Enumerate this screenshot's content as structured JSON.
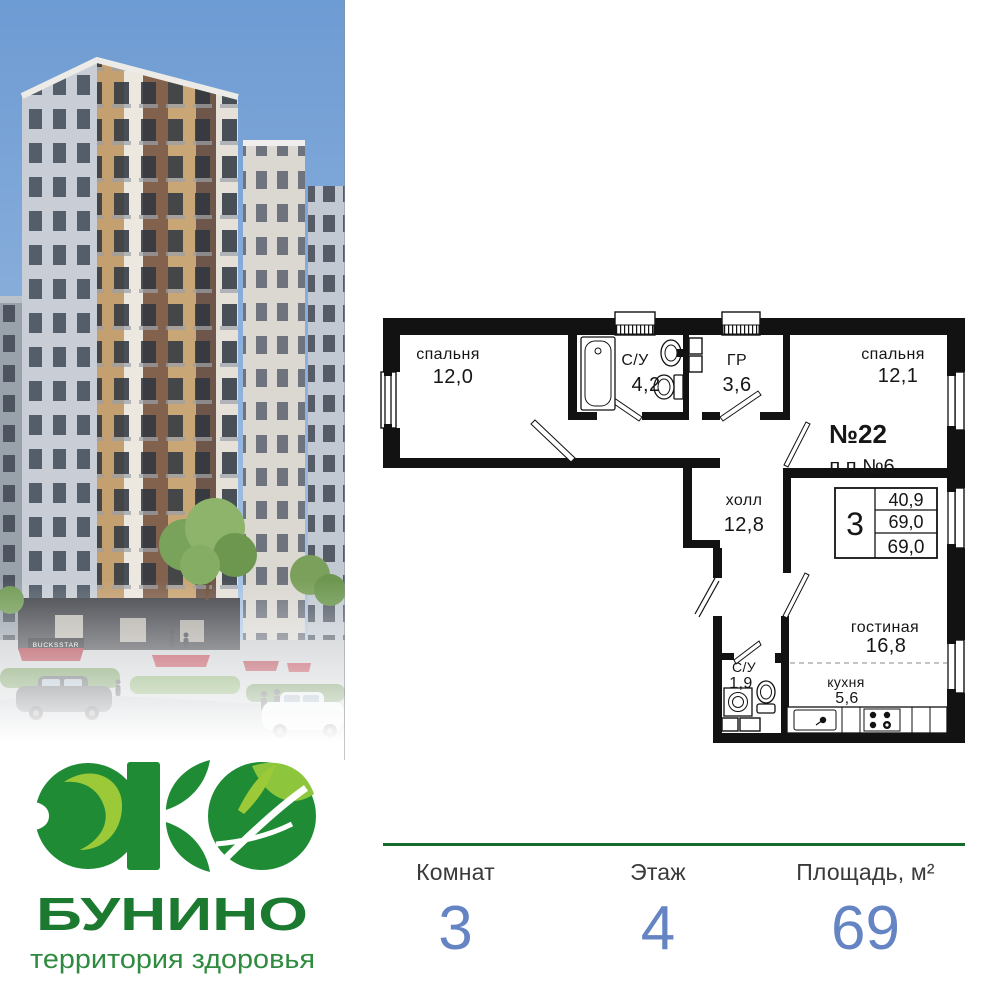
{
  "brand": {
    "logo_mark": "ЭКО",
    "name": "БУНИНО",
    "tagline": "территория здоровья",
    "shop_sign": "BUCKSSTAR",
    "colors": {
      "logo_green": "#1f8c35",
      "logo_light_green": "#9cc938",
      "divider_green": "#176a2d",
      "stat_blue": "#6484c3",
      "awning_red": "#a8323e"
    }
  },
  "floorplan": {
    "apartment_number": "№22",
    "entry_label": "п.п.№6",
    "rooms": [
      {
        "name": "спальня",
        "area": "12,0"
      },
      {
        "name": "С/У",
        "area": "4,2"
      },
      {
        "name": "ГР",
        "area": "3,6"
      },
      {
        "name": "спальня",
        "area": "12,1"
      },
      {
        "name": "холл",
        "area": "12,8"
      },
      {
        "name": "гостиная",
        "area": "16,8"
      },
      {
        "name": "С/У",
        "area": "1,9"
      },
      {
        "name": "кухня",
        "area": "5,6"
      }
    ],
    "summary_table": {
      "rooms_count": "3",
      "rows": [
        "40,9",
        "69,0",
        "69,0"
      ]
    }
  },
  "stats": [
    {
      "label": "Комнат",
      "value": "3"
    },
    {
      "label": "Этаж",
      "value": "4"
    },
    {
      "label": "Площадь, м²",
      "value": "69"
    }
  ]
}
